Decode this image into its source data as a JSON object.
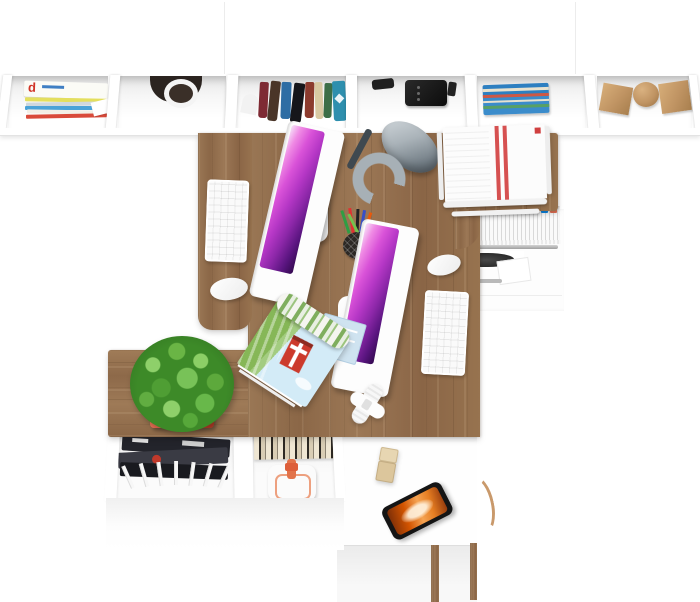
{
  "meta": {
    "title": "Top view render of a two-person office workstation",
    "domain_note": "furniture product photo, bird's-eye view, no UI text"
  },
  "palette": {
    "background": "#ffffff",
    "desk_wood": "#94704e",
    "shelf_white": "#ffffff",
    "screen_purple": [
      "#ef8ae4",
      "#b637c6",
      "#5a1580"
    ],
    "lamp_gray": "#97a1a8",
    "plant_green": "#57a33e",
    "pot_red": "#cf4a34",
    "phone_screen_orange": "#d35400",
    "poster_barn_red": "#cc3a2c"
  },
  "top_shelf": {
    "label": "long white wall shelf with six open compartments",
    "magazine_letter": "d",
    "compartments": [
      "stack of magazines",
      "dark hanging cup",
      "row of standing books",
      "black speaker unit",
      "pile of blue magazines",
      "wooden decor: cube, sphere, cube"
    ]
  },
  "desk": {
    "label": "L-shaped oak double desk with white storage",
    "workstation_1": {
      "monitor": "white all-in-one monitor, purple abstract wallpaper",
      "keyboard": "white keyboard",
      "mouse": "white mouse"
    },
    "workstation_2": {
      "monitor": "white all-in-one monitor, purple abstract wallpaper",
      "keyboard": "white keyboard",
      "mouse": "white mouse"
    },
    "lamp": "gray metal desk lamp",
    "document_tray": "white wire tray stacked with printed pages (red stripes)",
    "pen_cup": "black wire cup with colored pens",
    "poster": "rolled landscape poster with red barn, field and sky",
    "blue_papers": "folded light-blue documents",
    "cable": "coiled white cable with adapter"
  },
  "drawer_unit": {
    "label": "white pedestal, top drawer open with hanging files",
    "file_tab_colors": [
      "#e84393",
      "#6c5ce7",
      "#00b894",
      "#fdcb6e",
      "#d63031",
      "#0984e3",
      "#e17055"
    ]
  },
  "sideboard": {
    "label": "low oak sideboard",
    "plant": "green succulent in red-orange square pot",
    "lower_shelf_contents": [
      "dark magazines",
      "fanned white papers",
      "striped books",
      "white bag with orange straps"
    ]
  },
  "cabinet": {
    "label": "white low cabinet at bottom right",
    "items": [
      "smartphone with orange abstract screen",
      "wooden usb drive",
      "curved wooden handle"
    ]
  }
}
